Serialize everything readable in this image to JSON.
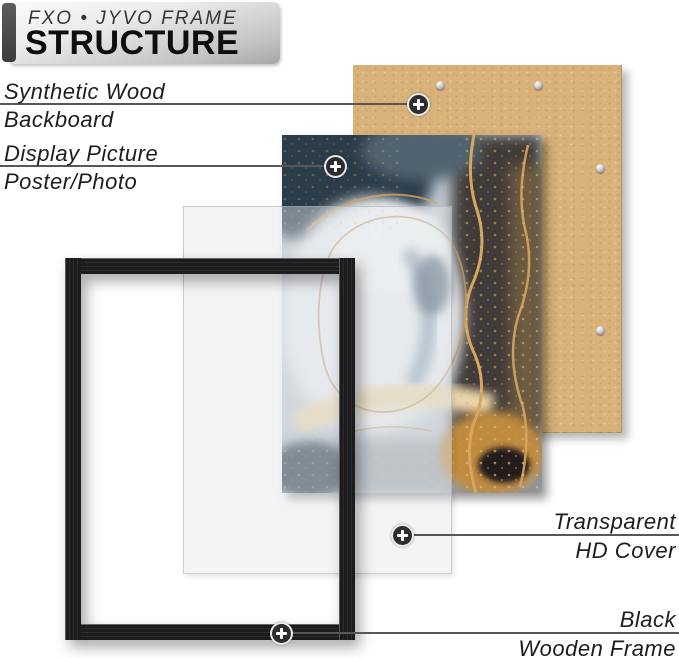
{
  "header": {
    "brand": "FXO • JYVO FRAME",
    "title": "STRUCTURE"
  },
  "labels": {
    "backboard": {
      "line1": "Synthetic Wood",
      "line2": "Backboard"
    },
    "picture": {
      "line1": "Display Picture",
      "line2": "Poster/Photo"
    },
    "cover": {
      "line1": "Transparent",
      "line2": "HD Cover"
    },
    "frame": {
      "line1": "Black",
      "line2": "Wooden Frame"
    }
  },
  "icons": {
    "marker": "plus-marker-icon",
    "screw": "screw-icon"
  },
  "colors": {
    "backboard_tan": "#d8b279",
    "frame_black": "#1c1c1f",
    "gold_vein": "#d6a55e",
    "leader_line": "#57575a",
    "sheet_gray": "#f2f3f6"
  }
}
